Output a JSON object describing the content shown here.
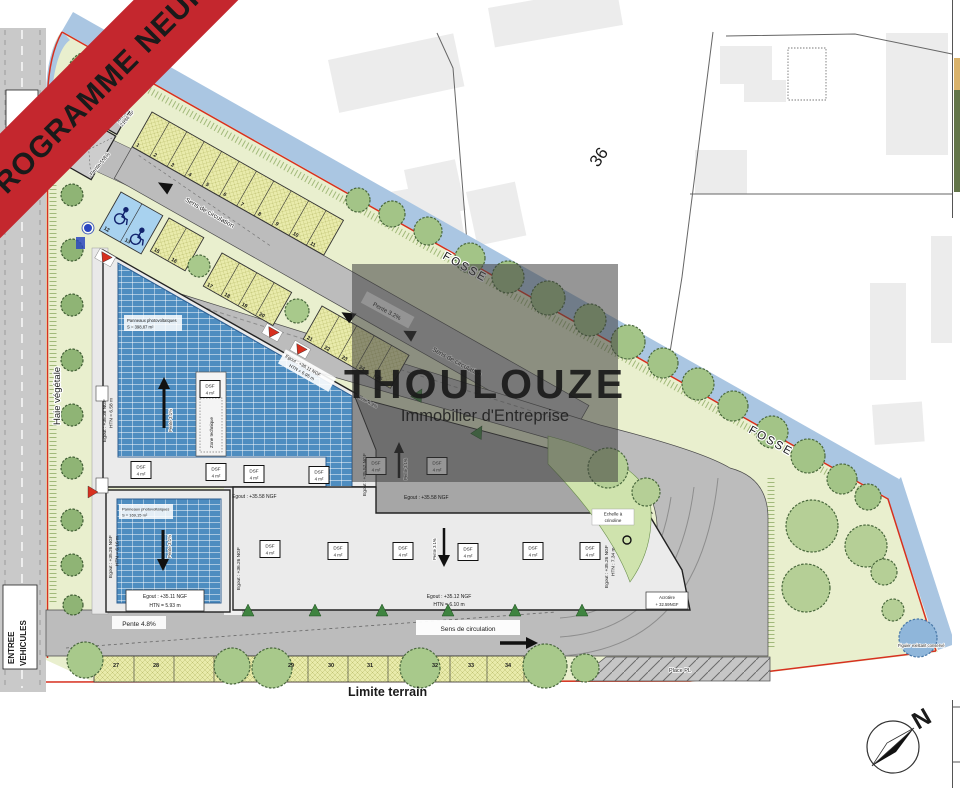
{
  "banner": {
    "label": "PROGRAMME NEUF",
    "color": "#c4272e"
  },
  "watermark": {
    "title": "THOULOUZE",
    "subtitle": "Immobilier d'Entreprise"
  },
  "roads": {
    "sens_label": "Sens de circulation",
    "sortie_1": "SORTIE",
    "sortie_2": "VEHICULES",
    "entree_1": "ENTREE",
    "entree_2": "VEHICULES",
    "place_pl": "Place PL"
  },
  "boundary": {
    "fosse": "FOSSE",
    "limite": "Limite terrain",
    "haie": "Haie végétale",
    "parcel_number": "36",
    "figuier": "Figuier existant conservé"
  },
  "slopes": {
    "p58": "Pente 5.8%",
    "p32": "Pente 3.2%",
    "p31": "Pente 3.1%",
    "p48": "Pente 4.8%",
    "p49": "Pente 4.9%"
  },
  "aire_om": {
    "line1": "Aire OM",
    "line2": "21,86 m²"
  },
  "pv": {
    "label": "Panneaux photovoltaïques",
    "area_main": "S = 398,87 m²",
    "area_small": "S = 169,15 m²"
  },
  "zone_technique": "Zone technique",
  "echelle": {
    "line1": "Echelle à",
    "line2": "crinoline"
  },
  "acrotere": {
    "line1": "Acrotère",
    "line2": "+ 32.59NGF"
  },
  "dsf": {
    "line1": "DSF",
    "line2": "4 m²"
  },
  "egout": {
    "e1": "Egout : +35.38 NGF",
    "e1b": "HTN = 6.58 m",
    "e2": "Egout : +36.11 NGF",
    "e2b": "HTN = 6.95 m",
    "e3": "Egout : +35.57 NGF",
    "e4": "Egout : +35.58 NGF",
    "e5": "Egout : +35.26 NGF",
    "e5b": "HTN = 6.16 m",
    "e6": "Egout : +35.11 NGF",
    "e6b": "HTN = 5.93 m",
    "e7": "Egout : +36.26 NGF",
    "e8": "Egout : +35.12 NGF",
    "e8b": "HTN = 6.10 m",
    "e9": "Egout : +35.26 NGF",
    "e9b": "HTN : 7.34 m"
  },
  "compass": {
    "north": "N"
  },
  "parking": {
    "row1": [
      "1",
      "2",
      "3",
      "4",
      "5",
      "6",
      "7",
      "8",
      "9",
      "10",
      "11"
    ],
    "row2_blue": [
      "12",
      "13"
    ],
    "row2_a": [
      "15",
      "16"
    ],
    "row2_b": [
      "17",
      "18",
      "19",
      "20"
    ],
    "row2_c": [
      "21",
      "22",
      "23",
      "24",
      "25"
    ],
    "spot26": "26",
    "bottom": [
      "27",
      "28",
      "29",
      "30",
      "31",
      "32",
      "33",
      "34"
    ]
  }
}
